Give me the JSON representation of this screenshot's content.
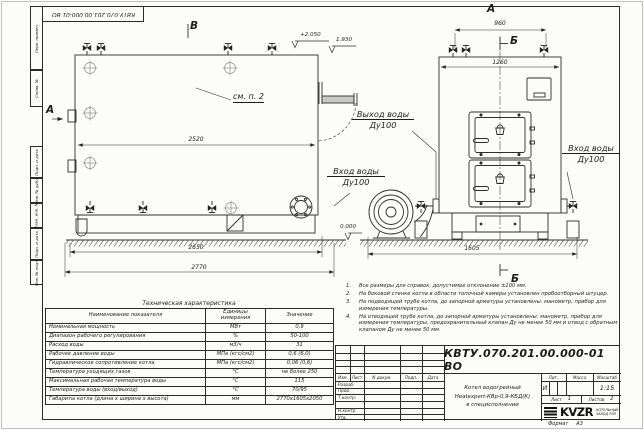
{
  "sheet": {
    "stamp_top_left": "КВТУ.070.201.00.000-01 ВО",
    "margin_labels": [
      "Перв. примен.",
      "Справ. №",
      "Подп. и дата",
      "Инв. № дубл.",
      "Взам. инв. №",
      "Подп. и дата",
      "Инв. № подл."
    ],
    "format_label": "Формат",
    "format_value": "А3"
  },
  "drawing": {
    "view_labels": {
      "b_view": "В",
      "a_side": "А",
      "a_front": "А",
      "b_section_top": "Б",
      "b_section_bottom": "Б"
    },
    "callout": "см. п. 2",
    "elevations": {
      "top": "+2.050",
      "outlet": "1.930",
      "ground": "0.000"
    },
    "dimensions": {
      "side_width": "2520",
      "side_base": "2650",
      "side_total": "2770",
      "front_top": "960",
      "front_width": "1260",
      "front_base": "1605"
    },
    "ports": {
      "outlet": {
        "line1": "Выход воды",
        "line2": "Ду100"
      },
      "inlet_left": {
        "line1": "Вход воды",
        "line2": "Ду100"
      },
      "inlet_right": {
        "line1": "Вход воды",
        "line2": "Ду100"
      }
    }
  },
  "spec_table": {
    "title": "Техническая характеристика",
    "headers": [
      "Наименование показателя",
      "Единицы измерения",
      "Значение"
    ],
    "rows": [
      [
        "Номинальная мощность",
        "МВт",
        "0,9"
      ],
      [
        "Диапазон рабочего регулирования",
        "%",
        "50-100"
      ],
      [
        "Расход воды",
        "м3/ч",
        "31"
      ],
      [
        "Рабочее давление воды",
        "МПа (кгс/см2)",
        "0,6 (6,0)"
      ],
      [
        "Гидравлическое сопротивление котла",
        "МПа (кгс/см2)",
        "0,06 (0,6)"
      ],
      [
        "Температура уходящих газов",
        "°С",
        "не более 250"
      ],
      [
        "Максимальная рабочая температура воды",
        "°С",
        "115"
      ],
      [
        "Температура воды (вход/выход)",
        "°С",
        "70/95"
      ],
      [
        "Габариты котла (длина х ширина х высота)",
        "мм",
        "2770х1605х2050"
      ]
    ]
  },
  "notes": {
    "items": [
      {
        "num": "1.",
        "text": "Все размеры для справок, допустимое отклонение ±100 мм."
      },
      {
        "num": "2.",
        "text": "На боковой стенке котла в области топочной камеры установлен пробоотборный штуцер."
      },
      {
        "num": "3.",
        "text": "На подводящей трубе котла, до запорной арматуры установлены: манометр, прибор для измерения температуры."
      },
      {
        "num": "4.",
        "text": "На отводящей трубе котла, до запорной арматуры установлены: манометр, прибор для измерения температуры, предохранительный клапан Ду не менее 50 мм и отвод с обратным клапаном Ду не менее 50 мм."
      }
    ]
  },
  "title_block": {
    "doc_number": "КВТУ.070.201.00.000-01 ВО",
    "rev_headers": [
      "Изм.",
      "Лист",
      "N докум.",
      "Подп.",
      "Дата"
    ],
    "sig_labels": [
      "Разраб.",
      "Пров.",
      "Т.контр.",
      "Н.контр.",
      "Утв."
    ],
    "product_title": {
      "line1": "Котел водогрейный",
      "line2": "Heatexpert-КВр-0,9-КБД(К)",
      "line3": "в специсполнении"
    },
    "lit_header": "Лит.",
    "mass_header": "Масса",
    "scale_header": "Масштаб",
    "lit_value": "И",
    "scale_value": "1:15",
    "sheet_label": "Лист",
    "sheet_value": "1",
    "sheets_label": "Листов",
    "sheets_value": "2",
    "logo_text": "KVZR",
    "company_line1": "КОТЕЛЬНЫЙ",
    "company_line2": "ЗАВОД РЭП"
  }
}
